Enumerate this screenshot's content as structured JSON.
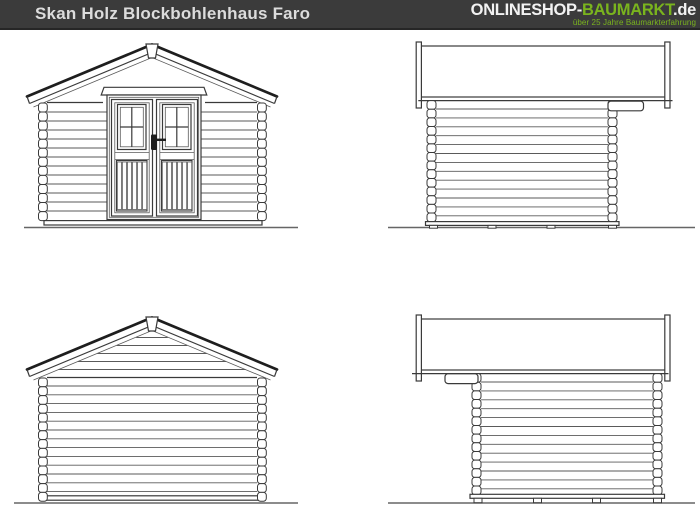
{
  "header": {
    "title": "Skan Holz Blockbohlenhaus Faro",
    "logo": {
      "part_shop": "ONLINESHOP-",
      "part_brand": "BAUMARKT",
      "part_tld": ".de",
      "tagline": "über 25 Jahre Baumarkterfahrung"
    }
  },
  "colors": {
    "header_bg": "#3b3b3b",
    "header_border": "#262626",
    "title_text": "#dcdcdc",
    "logo_text": "#f2f2f2",
    "accent_green": "#7ab41e",
    "drawing_line": "#3a3a3a",
    "drawing_line_strong": "#1e1e1e",
    "drawing_line_light": "#5a5a5a",
    "ground_line": "#666666",
    "canvas_bg": "#ffffff"
  }
}
